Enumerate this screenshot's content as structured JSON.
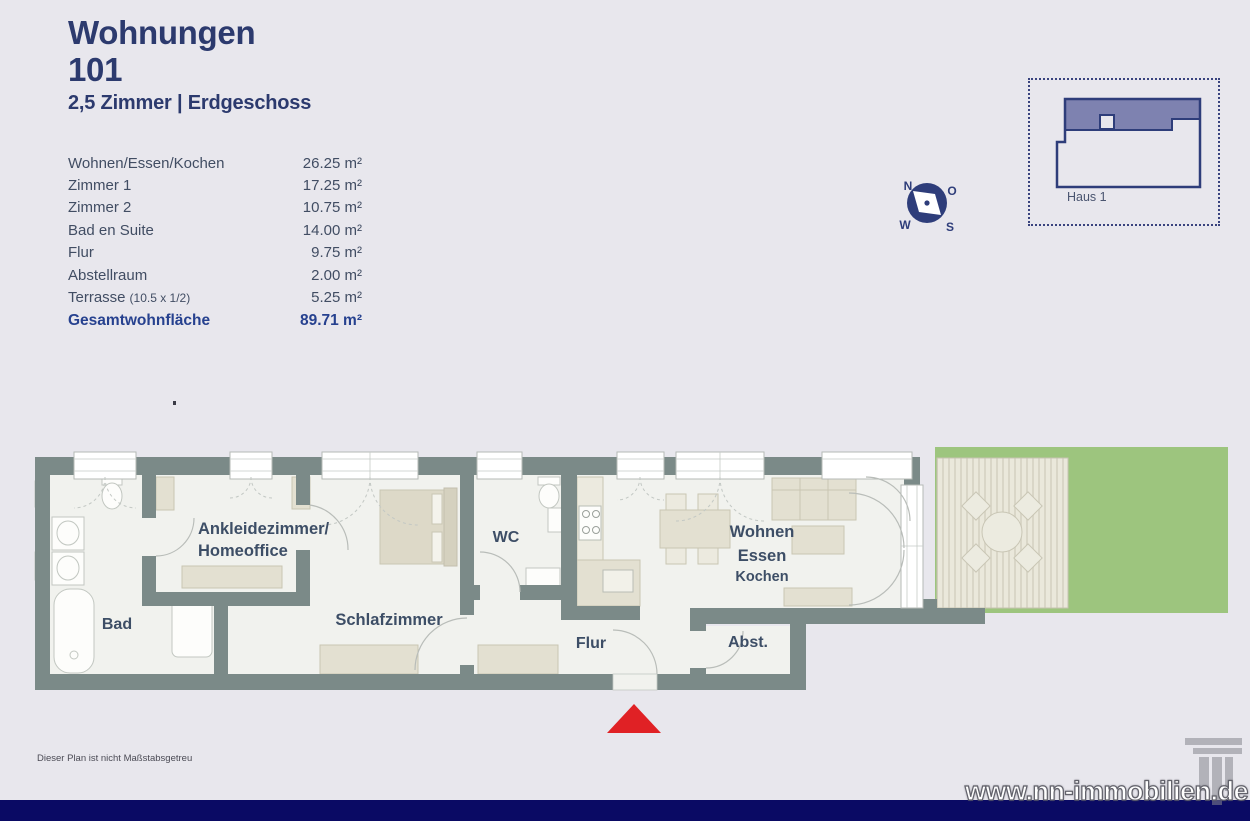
{
  "header": {
    "title_line1": "Wohnungen",
    "title_line2": "101",
    "subtitle": "2,5 Zimmer | Erdgeschoss"
  },
  "area_table": {
    "rows": [
      {
        "label": "Wohnen/Essen/Kochen",
        "note": "",
        "value": "26.25 m²"
      },
      {
        "label": "Zimmer 1",
        "note": "",
        "value": "17.25 m²"
      },
      {
        "label": "Zimmer 2",
        "note": "",
        "value": "10.75 m²"
      },
      {
        "label": "Bad en Suite",
        "note": "",
        "value": "14.00 m²"
      },
      {
        "label": "Flur",
        "note": "",
        "value": "9.75 m²"
      },
      {
        "label": "Abstellraum",
        "note": "",
        "value": "2.00 m²"
      },
      {
        "label": "Terrasse",
        "note": "(10.5 x 1/2)",
        "value": "5.25 m²"
      }
    ],
    "total": {
      "label": "Gesamtwohnfläche",
      "value": "89.71 m²"
    }
  },
  "compass": {
    "n": "N",
    "o": "O",
    "w": "W",
    "s": "S"
  },
  "site_plan": {
    "label": "Haus 1"
  },
  "floor_plan": {
    "labels": {
      "bad": "Bad",
      "ankleide_line1": "Ankleidezimmer/",
      "ankleide_line2": "Homeoffice",
      "schlafzimmer": "Schlafzimmer",
      "wc": "WC",
      "wohnen": "Wohnen",
      "essen": "Essen",
      "kochen": "Kochen",
      "flur": "Flur",
      "abstellraum": "Abst."
    }
  },
  "footer": {
    "disclaimer": "Dieser Plan ist nicht Maßstabsgetreu",
    "watermark": "www.nn-immobilien.de"
  },
  "colors": {
    "accent_navy": "#2c3a6e",
    "total_blue": "#26418f",
    "wall_gray": "#7b8a88",
    "lawn_green": "#9dc57e",
    "entrance_red": "#e02125",
    "bottom_bar_navy": "#0a0a64"
  }
}
